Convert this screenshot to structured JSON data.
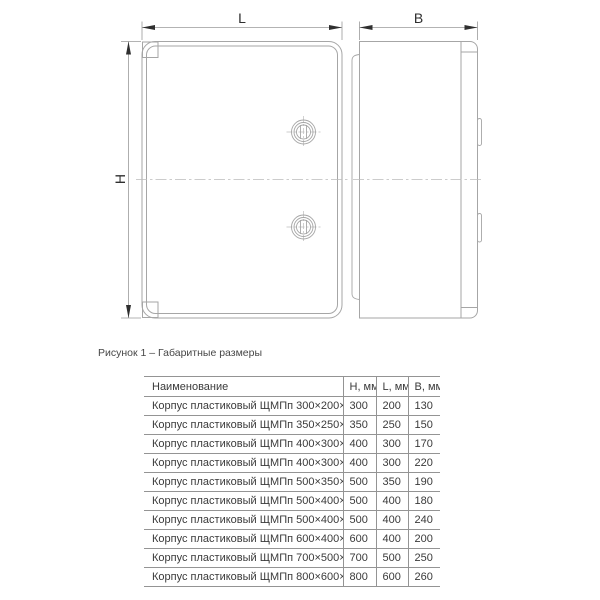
{
  "drawing": {
    "dim_length_label": "L",
    "dim_width_label": "B",
    "dim_height_label": "H",
    "caption": "Рисунок 1 – Габаритные размеры"
  },
  "table": {
    "headers": {
      "name": "Наименование",
      "h": "H, мм",
      "l": "L, мм",
      "b": "B, мм"
    },
    "rows": [
      {
        "name": "Корпус пластиковый ЩМПп 300×200×130",
        "h": "300",
        "l": "200",
        "b": "130"
      },
      {
        "name": "Корпус пластиковый ЩМПп 350×250×150",
        "h": "350",
        "l": "250",
        "b": "150"
      },
      {
        "name": "Корпус пластиковый ЩМПп 400×300×170",
        "h": "400",
        "l": "300",
        "b": "170"
      },
      {
        "name": "Корпус пластиковый ЩМПп 400×300×220",
        "h": "400",
        "l": "300",
        "b": "220"
      },
      {
        "name": "Корпус пластиковый ЩМПп 500×350×190",
        "h": "500",
        "l": "350",
        "b": "190"
      },
      {
        "name": "Корпус пластиковый ЩМПп 500×400×180",
        "h": "500",
        "l": "400",
        "b": "180"
      },
      {
        "name": "Корпус пластиковый ЩМПп 500×400×240",
        "h": "500",
        "l": "400",
        "b": "240"
      },
      {
        "name": "Корпус пластиковый ЩМПп 600×400×200",
        "h": "600",
        "l": "400",
        "b": "200"
      },
      {
        "name": "Корпус пластиковый ЩМПп 700×500×250",
        "h": "700",
        "l": "500",
        "b": "250"
      },
      {
        "name": "Корпус пластиковый ЩМПп 800×600×260",
        "h": "800",
        "l": "600",
        "b": "260"
      }
    ]
  },
  "colors": {
    "outline": "#a6a6a6",
    "dimension_line": "#9a9a9a",
    "arrow": "#2f2f2f",
    "centerline": "#bcbcbc",
    "table_border": "#949494",
    "text": "#3a3a3a",
    "background": "#ffffff"
  }
}
